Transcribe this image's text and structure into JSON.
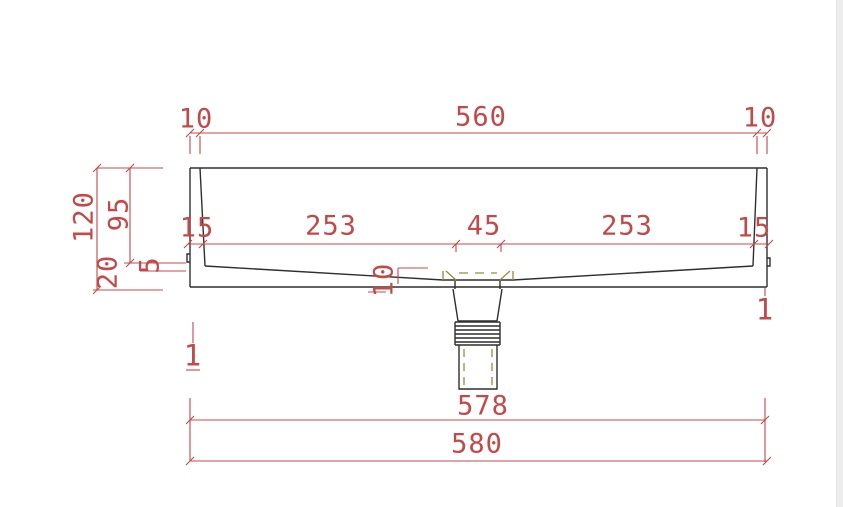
{
  "drawing": {
    "type": "technical-section-drawing",
    "colors": {
      "dimension_red": "#c44848",
      "outline_black": "#2f2f2f",
      "hidden_olive": "#9c8a3c",
      "background": "#ffffff",
      "edge_strip": "#ededed"
    },
    "dimensions": {
      "top": {
        "left_offset": "10",
        "width": "560",
        "right_offset": "10"
      },
      "left": {
        "total_height": "120",
        "basin_depth": "95",
        "base_height": "20",
        "step": "5"
      },
      "chain": {
        "left_wall": "15",
        "left_span": "253",
        "drain_width": "45",
        "right_span": "253",
        "right_wall": "15"
      },
      "drain": {
        "floor_thickness": "10"
      },
      "marks": {
        "left": "1",
        "right": "1"
      },
      "bottom": {
        "inner_width": "578",
        "outer_width": "580"
      }
    }
  }
}
